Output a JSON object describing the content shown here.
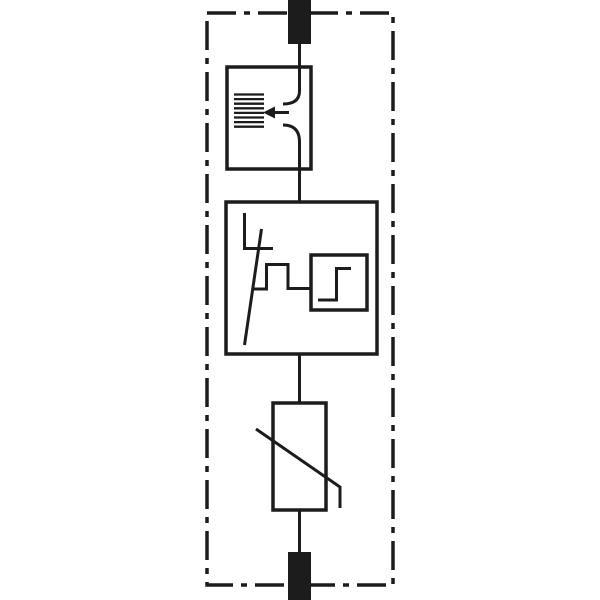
{
  "meta": {
    "description": "Circuit diagram of a surge protective device (SPD): series spark gap with arc splitter, thermal disconnector with status indicator, and varistor between two terminals inside a dash-dot enclosure boundary",
    "visible_text": ""
  },
  "colors": {
    "line": "#1c1c1c",
    "background": "#ffffff",
    "terminal_fill": "#1c1c1c"
  },
  "diagram": {
    "canvas": {
      "width": 600,
      "height": 600
    },
    "stroke_color": "#1c1c1c",
    "shapes": [
      {
        "name": "enclosure-dash-dot-boundary",
        "type": "rect",
        "x": 207,
        "y": 13,
        "w": 186,
        "h": 572,
        "sw": 3.5,
        "dash": "29 8 6 8"
      },
      {
        "name": "terminal-block-top",
        "type": "rect",
        "x": 288,
        "y": 0,
        "w": 23,
        "h": 44,
        "fill": true
      },
      {
        "name": "spark-gap-box",
        "type": "rect",
        "x": 227,
        "y": 67,
        "w": 84,
        "h": 102,
        "sw": 3.5
      },
      {
        "name": "arc-splitter-plates",
        "type": "plates",
        "x1": 234,
        "x2": 264,
        "y": 94.5,
        "step": 4.6,
        "count": 8,
        "sw": 2.3
      },
      {
        "name": "spark-gap-electrode-upper",
        "type": "path",
        "d": "M 299.5 44 L 299.5 91 Q 299.5 104 283 104",
        "sw": 3
      },
      {
        "name": "spark-gap-electrode-lower",
        "type": "path",
        "d": "M 283 125 Q 299.5 125 299.5 142 L 299.5 203",
        "sw": 3
      },
      {
        "name": "arc-direction-arrow-shaft",
        "type": "line",
        "x1": 274,
        "y1": 112.5,
        "x2": 289,
        "y2": 112.5,
        "sw": 3
      },
      {
        "name": "arc-direction-arrow-head",
        "type": "polygon",
        "points": "263,112.5 275,106.5 275,118.5"
      },
      {
        "name": "disconnector-box",
        "type": "rect",
        "x": 226,
        "y": 202,
        "w": 151,
        "h": 152,
        "sw": 3.5
      },
      {
        "name": "disconnector-lead",
        "type": "line",
        "x1": 244.5,
        "y1": 213,
        "x2": 244.5,
        "y2": 249,
        "sw": 3
      },
      {
        "name": "disconnector-contact-bar",
        "type": "line",
        "x1": 243,
        "y1": 248.5,
        "x2": 273,
        "y2": 248.5,
        "sw": 3
      },
      {
        "name": "disconnector-blade",
        "type": "line",
        "x1": 261.5,
        "y1": 229,
        "x2": 244.5,
        "y2": 345,
        "sw": 3
      },
      {
        "name": "linkage-step-line",
        "type": "path",
        "d": "M 252.5 289 L 266.5 289 L 266.5 264.5 L 288 264.5 L 288 288.5 L 311 288.5",
        "sw": 3
      },
      {
        "name": "status-indicator-box",
        "type": "rect",
        "x": 311,
        "y": 255,
        "w": 56,
        "h": 55,
        "sw": 3.5
      },
      {
        "name": "switching-characteristic-step",
        "type": "path",
        "d": "M 318 300 L 336.5 300 L 336.5 268.5 L 351 268.5",
        "sw": 3
      },
      {
        "name": "conductor-disconnector-to-varistor",
        "type": "line",
        "x1": 299.5,
        "y1": 354,
        "x2": 299.5,
        "y2": 404,
        "sw": 3
      },
      {
        "name": "varistor-body",
        "type": "rect",
        "x": 273,
        "y": 403,
        "w": 53,
        "h": 107,
        "sw": 3.5
      },
      {
        "name": "varistor-diagonal",
        "type": "path",
        "d": "M 256 429 L 340 487 L 340 508",
        "sw": 3
      },
      {
        "name": "conductor-varistor-to-terminal",
        "type": "line",
        "x1": 299.5,
        "y1": 510,
        "x2": 299.5,
        "y2": 554,
        "sw": 3
      },
      {
        "name": "terminal-block-bottom",
        "type": "rect",
        "x": 288,
        "y": 552,
        "w": 23,
        "h": 48,
        "fill": true
      }
    ]
  }
}
